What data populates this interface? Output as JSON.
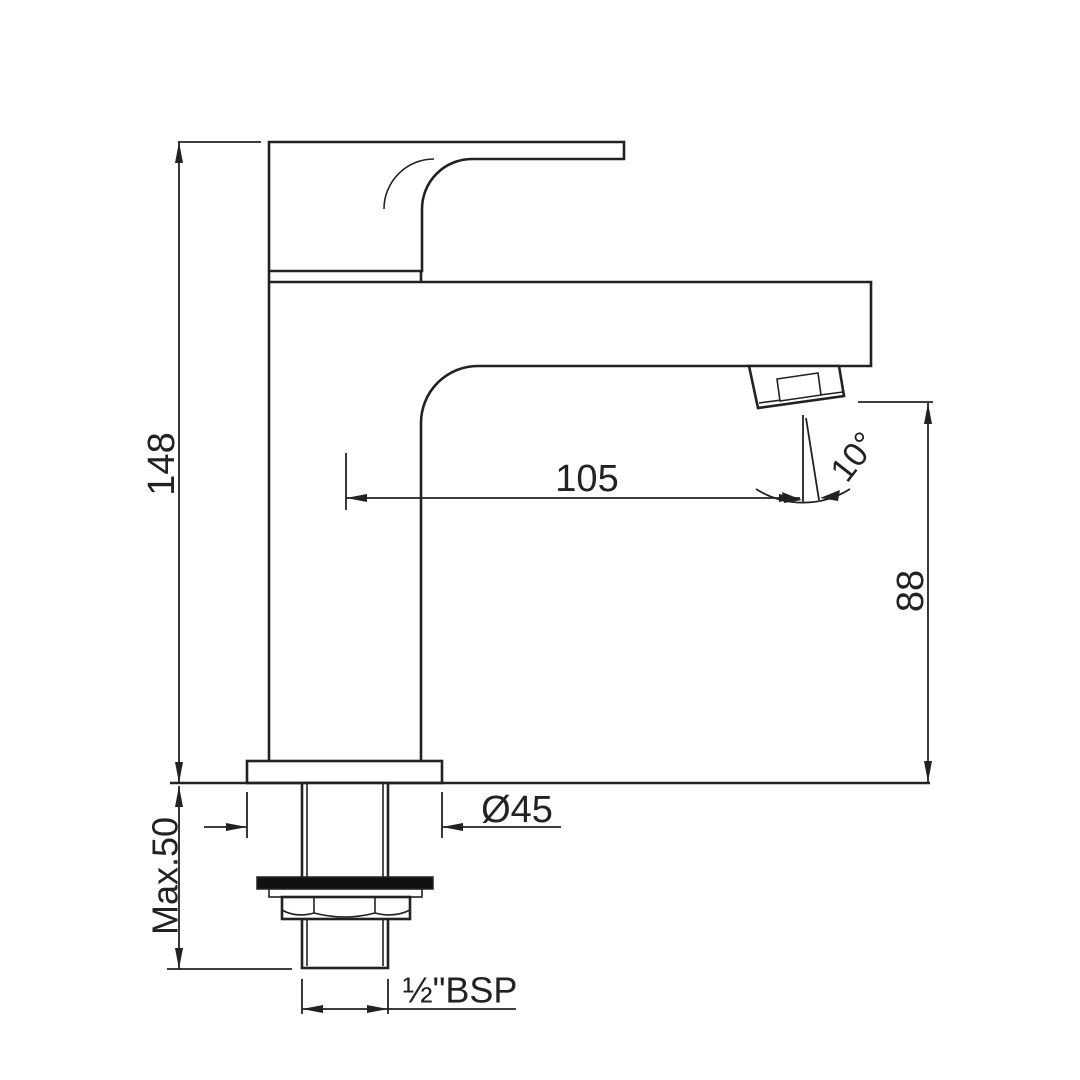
{
  "drawing": {
    "type": "faucet-installation-dimension-drawing",
    "dimensions": {
      "total_height": "148",
      "spout_reach": "105",
      "spout_outlet_height": "88",
      "max_deck_thickness": "Max.50",
      "base_diameter": "Ø45",
      "spray_angle": "10°",
      "inlet_thread": "½\"BSP"
    }
  },
  "colors": {
    "line": "#222222",
    "background": "#ffffff",
    "washer": "#111111"
  }
}
